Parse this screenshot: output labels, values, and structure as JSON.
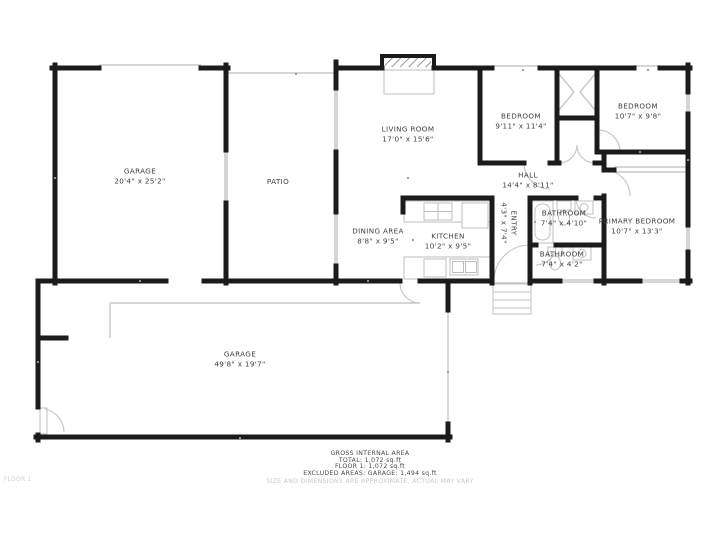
{
  "colors": {
    "wall": "#1b1b1b",
    "thin": "#c9c9c9",
    "glass": "#d6d6d6",
    "fixture": "#bfbfbf",
    "arc": "#c4c4c4",
    "label": "#3f3f3f",
    "summary": "#4a4a4a",
    "muted": "#c9c9c9",
    "bg": "#ffffff"
  },
  "rooms": [
    {
      "name": "GARAGE",
      "dims": "20'4\" x 25'2\""
    },
    {
      "name": "PATIO",
      "dims": ""
    },
    {
      "name": "LIVING ROOM",
      "dims": "17'0\" x 15'6\""
    },
    {
      "name": "BEDROOM",
      "dims": "9'11\" x 11'4\""
    },
    {
      "name": "BEDROOM",
      "dims": "10'7\" x 9'8\""
    },
    {
      "name": "HALL",
      "dims": "14'4\" x 8'11\""
    },
    {
      "name": "ENTRY",
      "dims": "4'3\" x 7'4\""
    },
    {
      "name": "BATHROOM",
      "dims": "7'4\" x 4'10\""
    },
    {
      "name": "PRIMARY BEDROOM",
      "dims": "10'7\" x 13'3\""
    },
    {
      "name": "BATHROOM",
      "dims": "7'4\" x 4'2\""
    },
    {
      "name": "DINING AREA",
      "dims": "8'8\" x 9'5\""
    },
    {
      "name": "KITCHEN",
      "dims": "10'2\" x 9'5\""
    },
    {
      "name": "GARAGE",
      "dims": "49'8\" x 19'7\""
    }
  ],
  "summary": {
    "title": "GROSS INTERNAL AREA",
    "total": "TOTAL: 1,072 sq.ft",
    "floor": "FLOOR 1: 1,072 sq.ft",
    "excluded": "EXCLUDED AREAS: GARAGE: 1,494 sq.ft",
    "disclaimer": "SIZE AND DIMENSIONS ARE APPROXIMATE, ACTUAL MAY VARY"
  },
  "footer": {
    "floor_tag": "FLOOR 1"
  }
}
